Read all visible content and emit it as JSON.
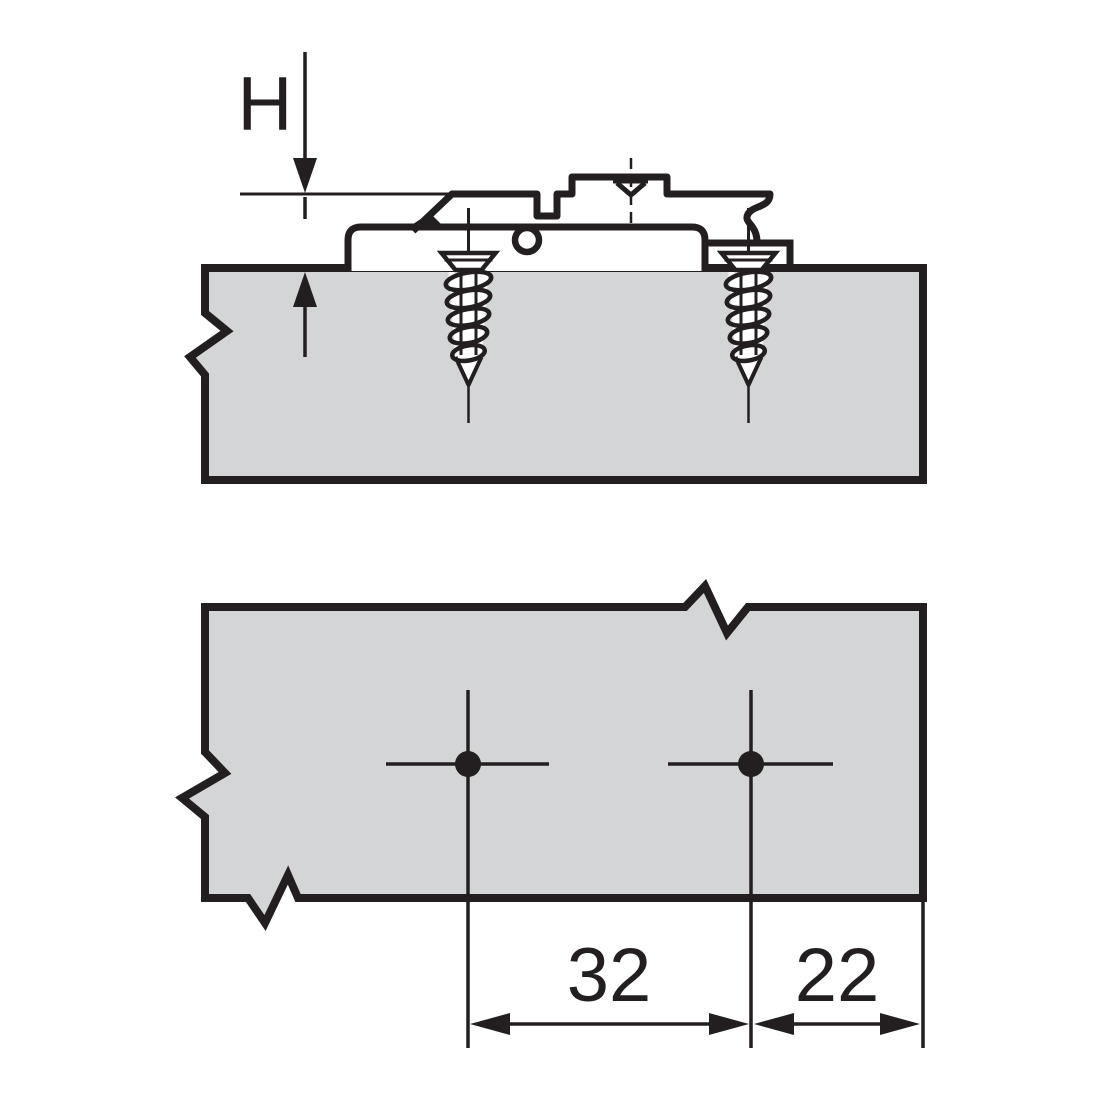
{
  "diagram": {
    "type": "technical-installation-drawing",
    "description": "Hinge mounting plate screwed onto a panel: side section view with height dimension, plan view with two drilling positions",
    "labels": {
      "height": "H",
      "hole_spacing": "32",
      "edge_distance": "22"
    },
    "colors": {
      "line": "#231f20",
      "panel_fill": "#d4d5d7",
      "background": "#ffffff"
    }
  }
}
